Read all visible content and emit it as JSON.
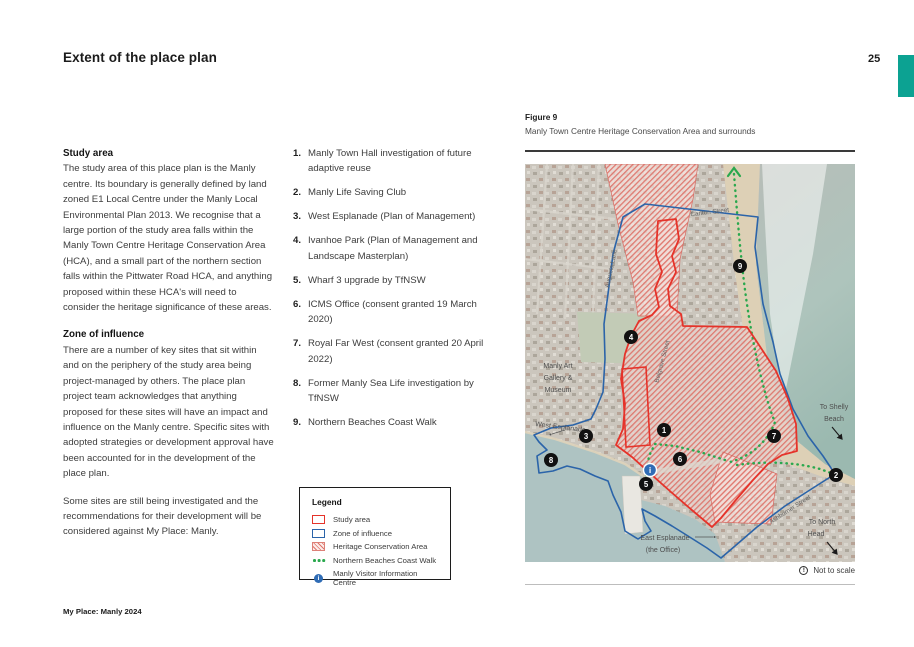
{
  "page": {
    "title": "Extent of the place plan",
    "page_number": "25",
    "footer": "My Place: Manly 2024",
    "accent_color": "#0ca292"
  },
  "study_area": {
    "heading": "Study area",
    "body": "The study area of this place plan is the Manly centre. Its boundary is generally defined by land zoned E1 Local Centre under the Manly Local Environmental Plan 2013. We recognise that a large portion of the study area falls within the Manly Town Centre Heritage Conservation Area (HCA), and a small part of the northern section falls within the Pittwater Road HCA, and anything proposed within these HCA's will need to consider the heritage significance of these areas."
  },
  "zone_of_influence": {
    "heading": "Zone of influence",
    "para1": "There are a number of key sites that sit within and on the periphery of the study area being project-managed by others. The place plan project team acknowledges that anything proposed for these sites will have an impact and influence on the Manly centre. Specific sites with adopted strategies or development approval have been accounted for in the development of the place plan.",
    "para2": "Some sites are still being investigated and the recommendations for their development will be considered against My Place: Manly."
  },
  "sites": [
    {
      "num": "1.",
      "label": "Manly Town Hall investigation of future adaptive reuse"
    },
    {
      "num": "2.",
      "label": "Manly Life Saving Club"
    },
    {
      "num": "3.",
      "label": "West Esplanade (Plan of Management)"
    },
    {
      "num": "4.",
      "label": "Ivanhoe Park (Plan of Management and Landscape Masterplan)"
    },
    {
      "num": "5.",
      "label": "Wharf 3 upgrade by TfNSW"
    },
    {
      "num": "6.",
      "label": "ICMS Office (consent granted 19 March 2020)"
    },
    {
      "num": "7.",
      "label": "Royal Far West (consent granted 20 April 2022)"
    },
    {
      "num": "8.",
      "label": "Former Manly Sea Life investigation by TfNSW"
    },
    {
      "num": "9.",
      "label": "Northern Beaches Coast Walk"
    }
  ],
  "figure": {
    "label": "Figure 9",
    "caption": "Manly Town Centre Heritage Conservation Area and surrounds",
    "note": "Not to scale"
  },
  "legend": {
    "title": "Legend",
    "items": [
      {
        "label": "Study area"
      },
      {
        "label": "Zone of influence"
      },
      {
        "label": "Heritage Conservation Area"
      },
      {
        "label": "Northern Beaches Coast Walk"
      },
      {
        "label": "Manly Visitor Information Centre"
      }
    ]
  },
  "map": {
    "marker_numbers": [
      "1",
      "2",
      "3",
      "4",
      "5",
      "6",
      "7",
      "8",
      "9"
    ],
    "labels": {
      "carlton": "Carlton Street",
      "augusta": "Augusta Lane",
      "belgrave": "Belgrave Street",
      "ashburner": "Ashburner Street",
      "gallery1": "Manly Art",
      "gallery2": "Gallery &",
      "gallery3": "Museum",
      "west_esplanade": "West Esplanade",
      "east_esplanade1": "East Esplanade",
      "east_esplanade2": "(the Office)",
      "shelly1": "To Shelly",
      "shelly2": "Beach",
      "north1": "To North",
      "north2": "Head"
    },
    "colors": {
      "study_area": "#e5332a",
      "zone_of_influence": "#2b64a9",
      "heritage_hatch": "#dd6a60",
      "coast_walk": "#2aa84e",
      "info_centre": "#2f6cb5"
    }
  },
  "icons": {
    "info": "i",
    "alert": "!"
  }
}
